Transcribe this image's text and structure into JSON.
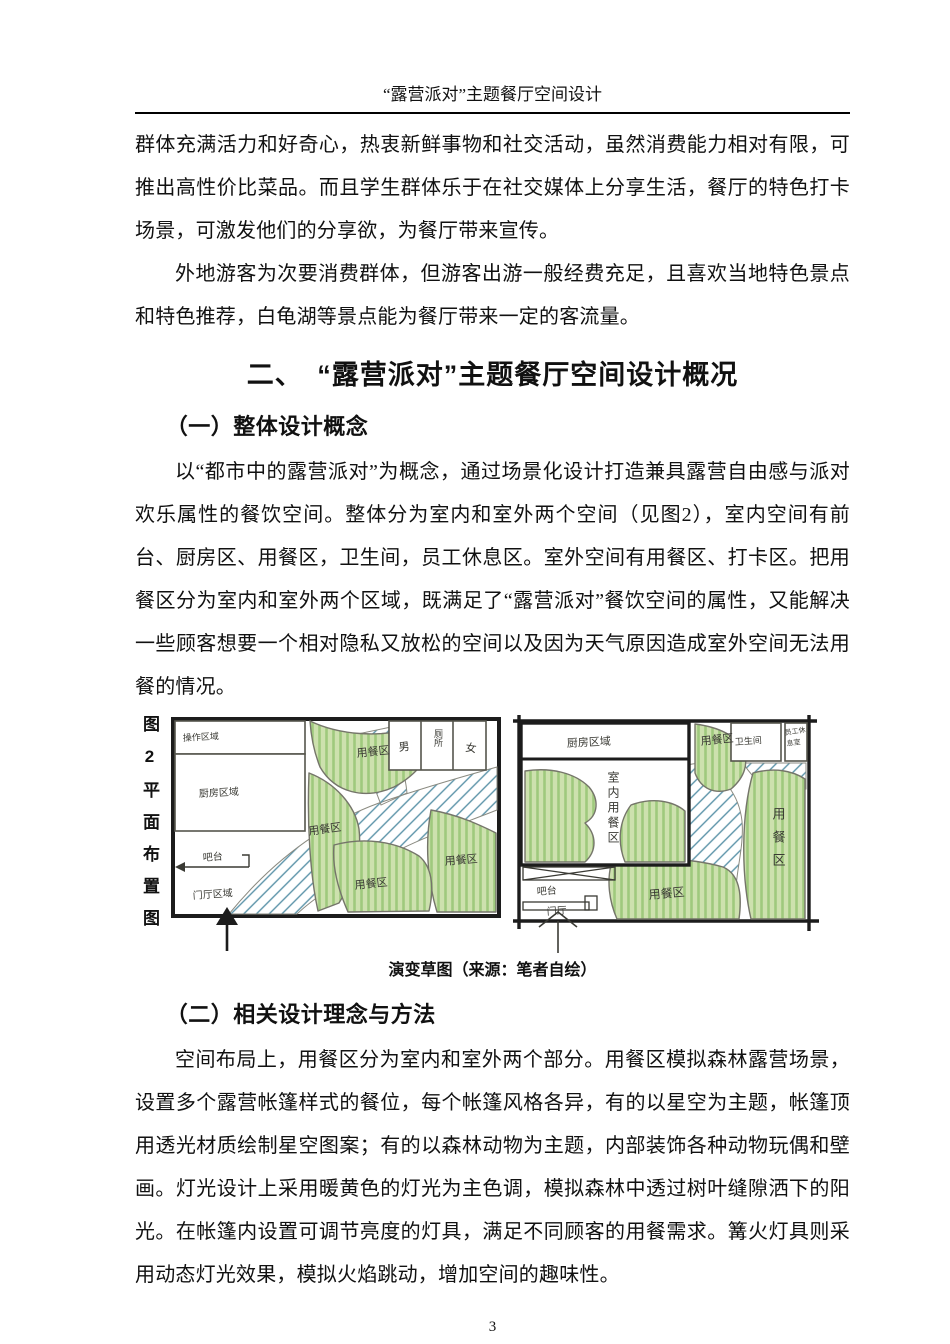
{
  "header": {
    "title": "“露营派对”主题餐厅空间设计"
  },
  "intro": {
    "p1": "群体充满活力和好奇心，热衷新鲜事物和社交活动，虽然消费能力相对有限，可推出高性价比菜品。而且学生群体乐于在社交媒体上分享生活，餐厅的特色打卡场景，可激发他们的分享欲，为餐厅带来宣传。",
    "p2": "外地游客为次要消费群体，但游客出游一般经费充足，且喜欢当地特色景点和特色推荐，白龟湖等景点能为餐厅带来一定的客流量。"
  },
  "section": {
    "title": "二、　“露营派对”主题餐厅空间设计概况",
    "sub1_title": "（一）整体设计概念",
    "sub1_body": "以“都市中的露营派对”为概念，通过场景化设计打造兼具露营自由感与派对欢乐属性的餐饮空间。整体分为室内和室外两个空间（见图2），室内空间有前台、厨房区、用餐区，卫生间，员工休息区。室外空间有用餐区、打卡区。把用餐区分为室内和室外两个区域，既满足了“露营派对”餐饮空间的属性，又能解决一些顾客想要一个相对隐私又放松的空间以及因为天气原因造成室外空间无法用餐的情况。",
    "sub2_title": "（二）相关设计理念与方法",
    "sub2_body": "空间布局上，用餐区分为室内和室外两个部分。用餐区模拟森林露营场景，设置多个露营帐篷样式的餐位，每个帐篷风格各异，有的以星空为主题，帐篷顶用透光材质绘制星空图案；有的以森林动物为主题，内部装饰各种动物玩偶和壁画。灯光设计上采用暖黄色的灯光为主色调，模拟森林中透过树叶缝隙洒下的阳光。在帐篷内设置可调节亮度的灯具，满足不同顾客的用餐需求。篝火灯具则采用动态灯光效果，模拟火焰跳动，增加空间的趣味性。"
  },
  "figure": {
    "side_label": "图2平面布置图",
    "caption": "演变草图（来源：笔者自绘）",
    "colors": {
      "green_fill": "#cde1ae",
      "green_stripe": "#9fc97d",
      "path_blue": "#5b93a8",
      "sketch_outline": "#75756a",
      "wall_black": "#1c1c1c"
    },
    "left_plan": {
      "labels": {
        "operation_area": "操作区域",
        "kitchen_area": "厨房区域",
        "dining": "用餐区",
        "male": "男",
        "toilet": "厕所",
        "female": "女",
        "bar": "吧台",
        "foyer": "门厅区域"
      }
    },
    "right_plan": {
      "labels": {
        "kitchen_area": "厨房区域",
        "indoor_dining": "室内用餐区",
        "dining": "用餐区",
        "restroom": "卫生间",
        "staff_line1": "员工休",
        "staff_line2": "息室",
        "bar": "吧台",
        "foyer": "门厅"
      }
    }
  },
  "page": {
    "number": "3"
  }
}
